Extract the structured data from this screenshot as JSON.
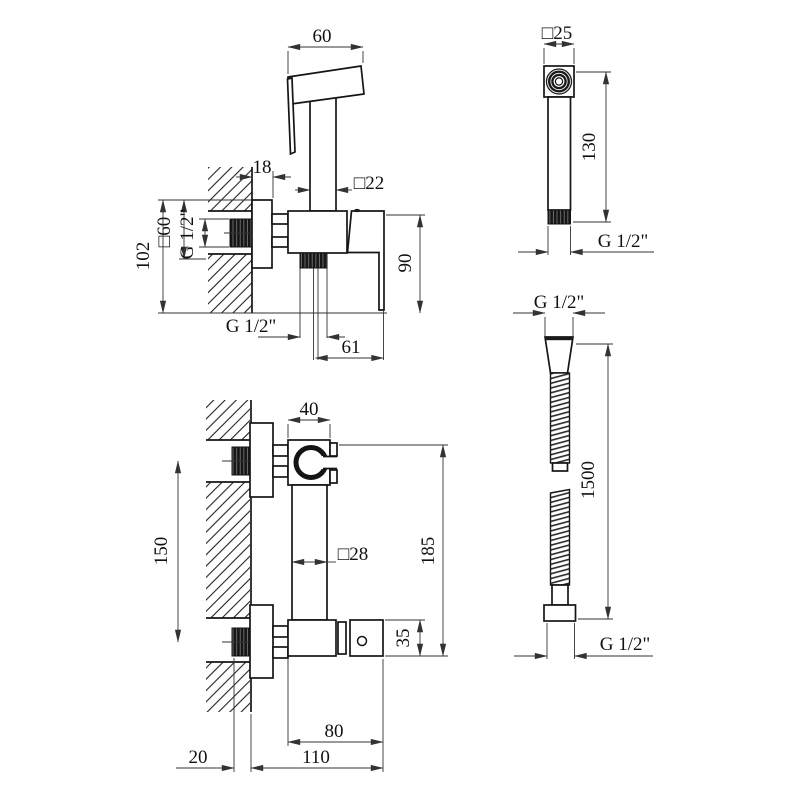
{
  "drawing": {
    "type": "technical-installation-drawing",
    "product": "wall-mounted bidet shower mixer set",
    "line_color": "#151515",
    "background": "#ffffff",
    "views": {
      "faucet_side": {
        "head_width": "60",
        "plate_depth": "18",
        "post_square": "□22",
        "plate_square": "□60",
        "inlet_thread": "G 1/2\"",
        "overall_height": "102",
        "body_height": "90",
        "outlet_thread": "G 1/2\"",
        "outlet_offset": "61"
      },
      "sprayer_front": {
        "head_square": "□25",
        "length": "130",
        "thread": "G 1/2\""
      },
      "faucet_front": {
        "holder_width": "40",
        "mount_centers": "150",
        "column_square": "□28",
        "total_height": "185",
        "valve_height": "35",
        "valve_length": "80",
        "total_length": "110",
        "wall_offset": "20"
      },
      "hose": {
        "thread_top": "G 1/2\"",
        "length": "1500",
        "thread_bottom": "G 1/2\""
      }
    }
  }
}
